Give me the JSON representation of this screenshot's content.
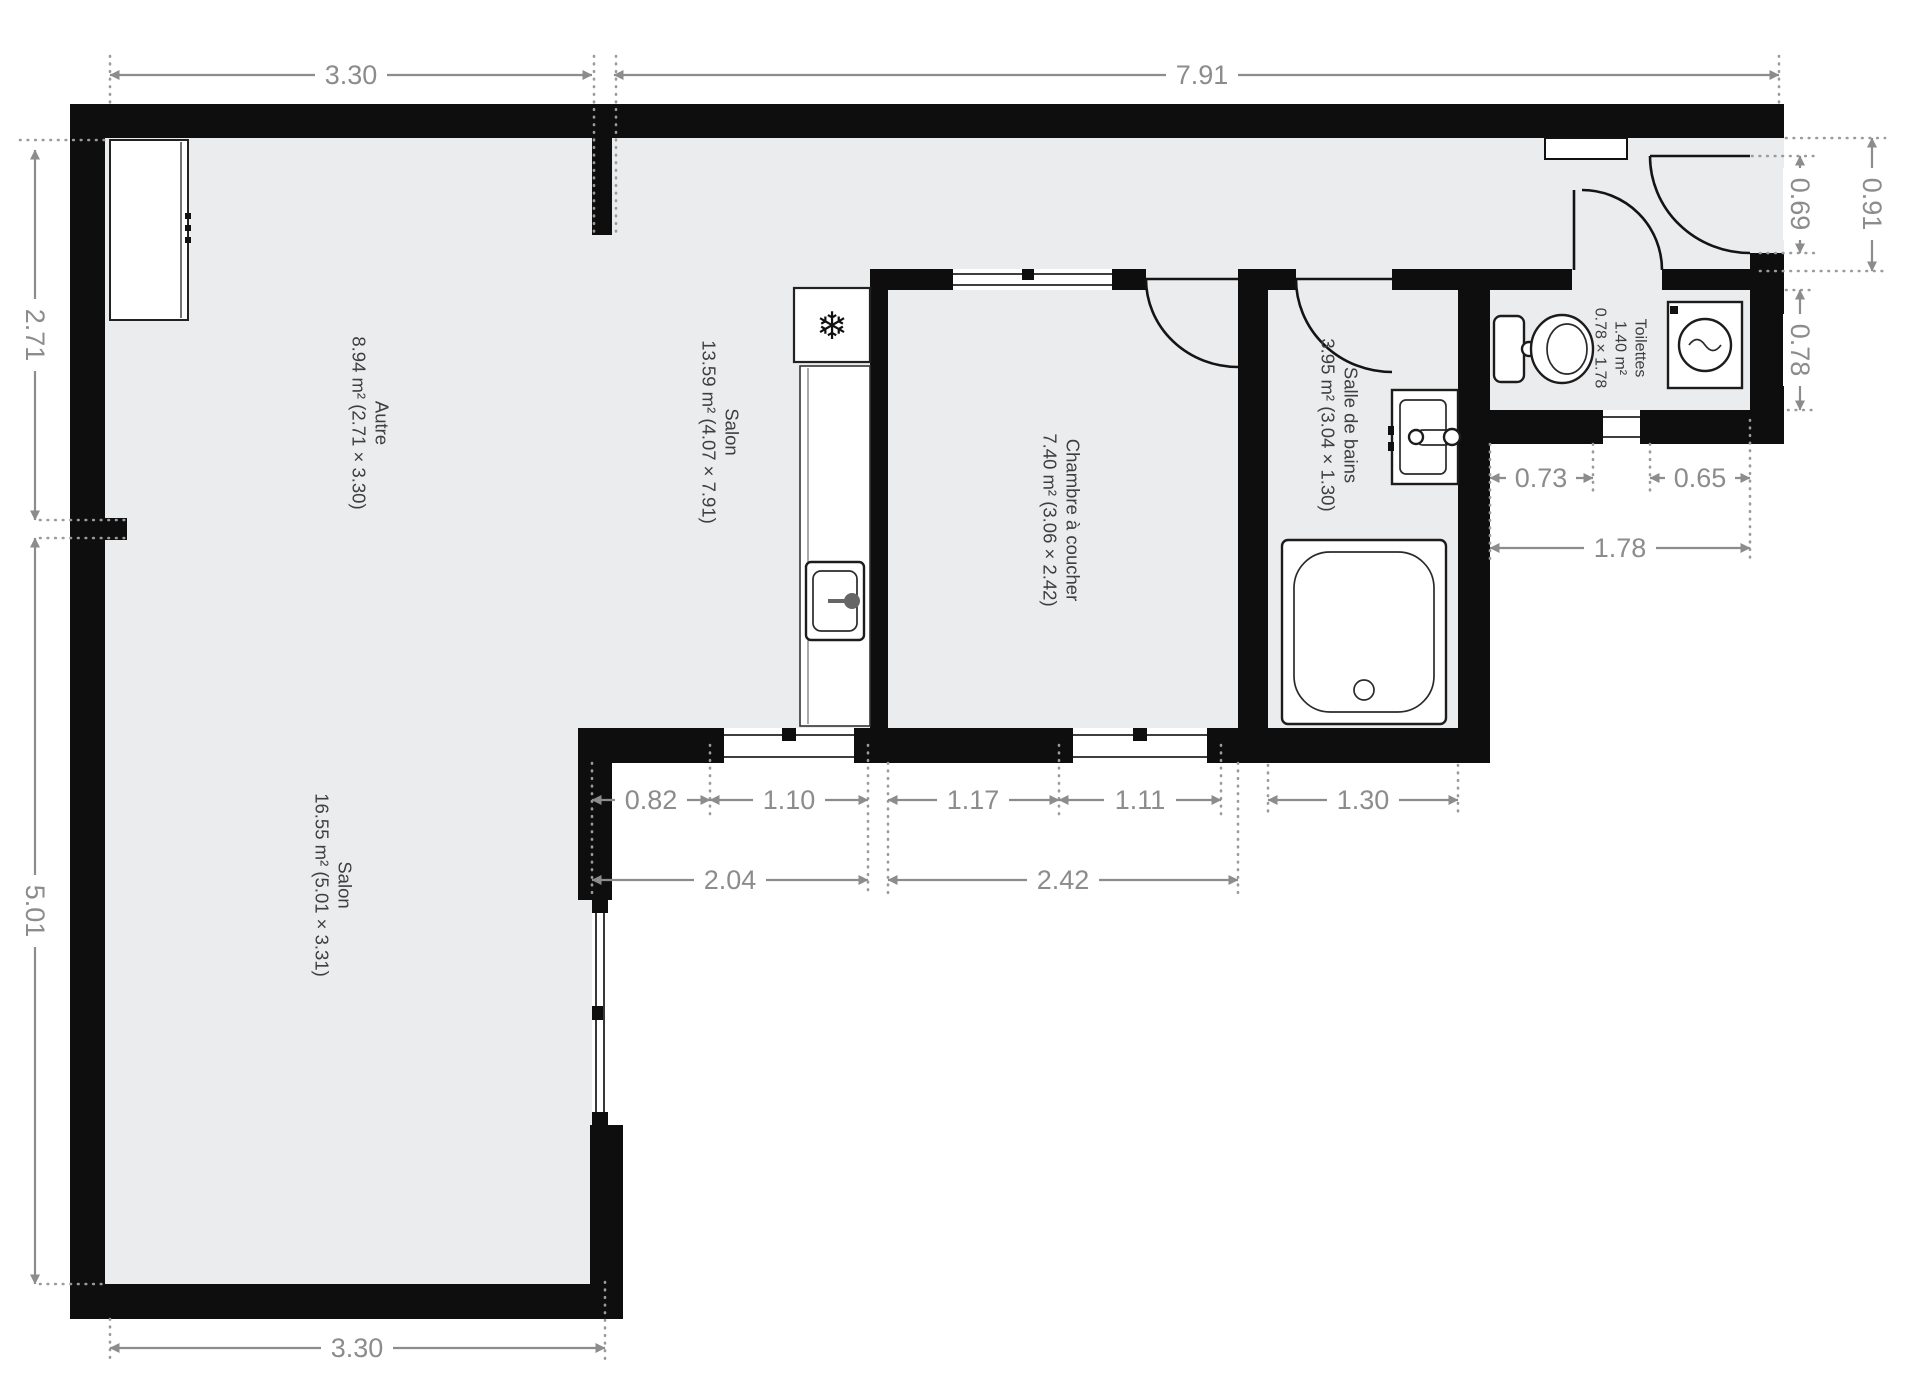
{
  "plan_title": "Appartement – plan d'étage",
  "dims": {
    "top_autre": "3.30",
    "top_salon": "7.91",
    "left_upper": "2.71",
    "left_lower": "5.01",
    "bottom": "3.30",
    "right_total": "0.91",
    "right_entry": "0.69",
    "right_toilettes": "0.78",
    "toilettes_left": "0.73",
    "toilettes_window": "0.65",
    "toilettes_width": "1.78",
    "salon_window_offset": "0.82",
    "salon_window": "1.10",
    "chambre_offset": "1.17",
    "chambre_window": "1.11",
    "sdb_width": "1.30",
    "salon_span": "2.04",
    "chambre_span": "2.42"
  },
  "rooms": {
    "autre": {
      "name": "Autre",
      "area": "8.94 m² (2.71 × 3.30)"
    },
    "salon_kitchen": {
      "name": "Salon",
      "area": "13.59 m² (4.07 × 7.91)"
    },
    "chambre": {
      "name": "Chambre à coucher",
      "area": "7.40 m² (3.06 × 2.42)"
    },
    "salle_de_bains": {
      "name": "Salle de bains",
      "area": "3.95 m² (3.04 × 1.30)"
    },
    "toilettes": {
      "name": "Toilettes",
      "area": "1.40 m²",
      "size": "0.78 × 1.78"
    },
    "salon_lower": {
      "name": "Salon",
      "area": "16.55 m² (5.01 × 3.31)"
    }
  },
  "icons": {
    "fridge": "❄"
  },
  "colors": {
    "wall": "#0e0e0e",
    "floor": "#ebeced",
    "dimension": "#8c8c8c",
    "room_text": "#3e3e3e"
  }
}
